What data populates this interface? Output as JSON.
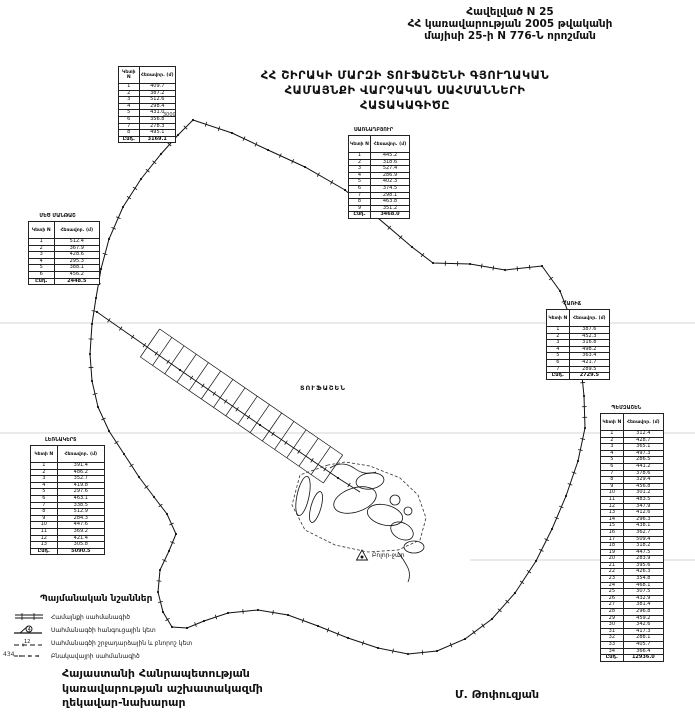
{
  "header": {
    "line1": "Հավելված N 25",
    "line2": "ՀՀ կառավարության 2005 թվականի",
    "line3": "մայիսի 25-ի N 776-Ն որոշման"
  },
  "title": {
    "line1": "ՀՀ ՇԻՐԱԿԻ ՄԱՐԶԻ ՏՈՒՖԱՇԵՆԻ ԳՅՈՒՂԱԿԱՆ",
    "line2": "ՀԱՄԱՅՆՔԻ ՎԱՐՉԱԿԱՆ ՍԱՀՄԱՆՆԵՐԻ",
    "line3": "ՀԱՏԱԿԱԳԻԾԸ"
  },
  "map": {
    "settlement_label": "ՏՈՒՖԱՇԵՆ",
    "mountain_label": "Բոլոր-ջար",
    "grid_label": "3000",
    "corner_number": "434",
    "ink_color": "#111111",
    "faint_line_color": "#999999"
  },
  "tables": [
    {
      "label": "",
      "col1": "Կետի N",
      "col2": "Հեռավոր. (մ)",
      "rows": [
        [
          "1",
          "409.7"
        ],
        [
          "2",
          "387.2"
        ],
        [
          "3",
          "512.6"
        ],
        [
          "4",
          "298.4"
        ],
        [
          "5",
          "431.0"
        ],
        [
          "6",
          "356.8"
        ],
        [
          "7",
          "278.3"
        ],
        [
          "8",
          "495.1"
        ]
      ],
      "total_label": "Ընդ.",
      "total": "3169.1"
    },
    {
      "label": "ՍԱՌՆԱՂԲՅՈՒՐ",
      "col1": "Կետի N",
      "col2": "Հեռավոր. (մ)",
      "rows": [
        [
          "1",
          "445.2"
        ],
        [
          "2",
          "318.6"
        ],
        [
          "3",
          "527.4"
        ],
        [
          "4",
          "286.9"
        ],
        [
          "5",
          "402.3"
        ],
        [
          "6",
          "374.5"
        ],
        [
          "7",
          "298.1"
        ],
        [
          "8",
          "463.8"
        ],
        [
          "9",
          "351.2"
        ]
      ],
      "total_label": "Ընդ.",
      "total": "3468.0"
    },
    {
      "label": "ՄԵԾ ՄԱՆԹԱՇ",
      "col1": "Կետի N",
      "col2": "Հեռավոր. (մ)",
      "rows": [
        [
          "1",
          "512.4"
        ],
        [
          "2",
          "367.9"
        ],
        [
          "3",
          "428.6"
        ],
        [
          "4",
          "295.3"
        ],
        [
          "5",
          "388.1"
        ],
        [
          "6",
          "456.2"
        ]
      ],
      "total_label": "Ընդ.",
      "total": "2448.5"
    },
    {
      "label": "ՀԱՌԻՃ",
      "col1": "Կետի N",
      "col2": "Հեռավոր. (մ)",
      "rows": [
        [
          "1",
          "387.6"
        ],
        [
          "2",
          "452.3"
        ],
        [
          "3",
          "316.8"
        ],
        [
          "4",
          "498.2"
        ],
        [
          "5",
          "363.4"
        ],
        [
          "6",
          "421.7"
        ],
        [
          "7",
          "289.5"
        ]
      ],
      "total_label": "Ընդ.",
      "total": "2729.5"
    },
    {
      "label": "ԼԵՌՆԱԿԵՐՏ",
      "col1": "Կետի N",
      "col2": "Հեռավոր. (մ)",
      "rows": [
        [
          "1",
          "391.4"
        ],
        [
          "2",
          "486.2"
        ],
        [
          "3",
          "352.7"
        ],
        [
          "4",
          "419.8"
        ],
        [
          "5",
          "297.6"
        ],
        [
          "6",
          "463.1"
        ],
        [
          "7",
          "338.5"
        ],
        [
          "8",
          "512.9"
        ],
        [
          "9",
          "284.3"
        ],
        [
          "10",
          "447.6"
        ],
        [
          "11",
          "369.2"
        ],
        [
          "12",
          "421.4"
        ],
        [
          "13",
          "305.8"
        ]
      ],
      "total_label": "Ընդ.",
      "total": "5090.5"
    },
    {
      "label": "ՊԵՄԶԱՇԵՆ",
      "col1": "Կետի N",
      "col2": "Հեռավոր. (մ)",
      "rows": [
        [
          "1",
          "312.4"
        ],
        [
          "2",
          "428.7"
        ],
        [
          "3",
          "365.1"
        ],
        [
          "4",
          "497.3"
        ],
        [
          "5",
          "286.5"
        ],
        [
          "6",
          "441.2"
        ],
        [
          "7",
          "378.6"
        ],
        [
          "8",
          "329.4"
        ],
        [
          "9",
          "456.8"
        ],
        [
          "10",
          "301.2"
        ],
        [
          "11",
          "483.5"
        ],
        [
          "12",
          "347.9"
        ],
        [
          "13",
          "412.6"
        ],
        [
          "14",
          "296.3"
        ],
        [
          "15",
          "438.1"
        ],
        [
          "16",
          "362.7"
        ],
        [
          "17",
          "509.4"
        ],
        [
          "18",
          "318.2"
        ],
        [
          "19",
          "447.5"
        ],
        [
          "20",
          "283.9"
        ],
        [
          "21",
          "395.6"
        ],
        [
          "22",
          "426.3"
        ],
        [
          "23",
          "354.8"
        ],
        [
          "24",
          "468.1"
        ],
        [
          "25",
          "307.5"
        ],
        [
          "26",
          "432.9"
        ],
        [
          "27",
          "381.4"
        ],
        [
          "28",
          "296.8"
        ],
        [
          "29",
          "459.2"
        ],
        [
          "30",
          "342.6"
        ],
        [
          "31",
          "417.3"
        ],
        [
          "32",
          "288.1"
        ],
        [
          "33",
          "405.7"
        ],
        [
          "34",
          "366.4"
        ]
      ],
      "total_label": "Ընդ.",
      "total": "12936.0"
    }
  ],
  "legend": {
    "title": "Պայմանական նշաններ",
    "items": [
      "Համայնքի սահմանագիծ",
      "Սահմանագծի հանգուցային կետ",
      "Սահմանագծի շրջադարձային և բնորոշ կետ",
      "Բնակավայրի սահմանագիծ"
    ]
  },
  "footer": {
    "org_line1": "Հայաստանի Հանրապետության",
    "org_line2": "կառավարության աշխատակազմի",
    "org_line3": "ղեկավար-նախարար",
    "signature": "Մ. Թոփուզյան"
  }
}
